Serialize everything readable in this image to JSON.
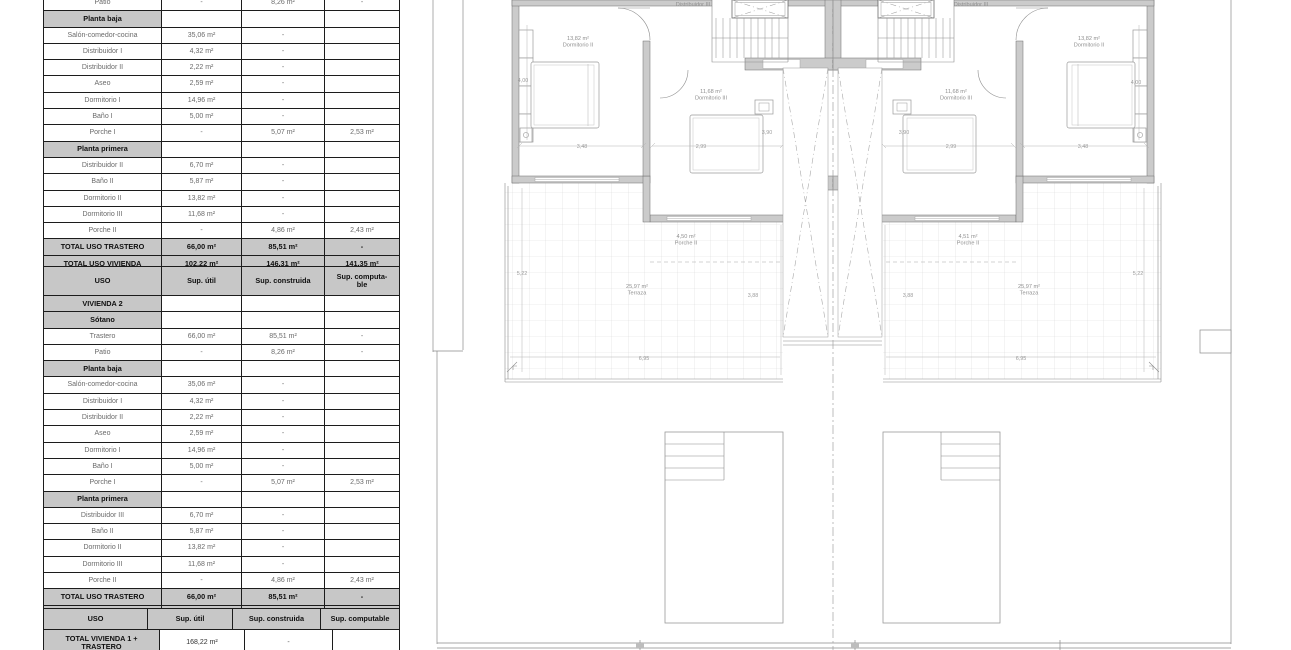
{
  "document": {
    "kind": "architectural plan sheet",
    "language": "es",
    "units": "m²"
  },
  "tables": {
    "columns": [
      "USO",
      "Sup. útil",
      "Sup. construida",
      "Sup. computable"
    ],
    "vivienda1": {
      "rows": [
        [
          "data",
          "Patio",
          "-",
          "8,26 m²",
          "-"
        ],
        [
          "section",
          "Planta baja",
          "",
          "",
          ""
        ],
        [
          "data",
          "Salón-comedor-cocina",
          "35,06 m²",
          "-",
          ""
        ],
        [
          "data",
          "Distribuidor I",
          "4,32 m²",
          "-",
          ""
        ],
        [
          "data",
          "Distribuidor II",
          "2,22 m²",
          "-",
          ""
        ],
        [
          "data",
          "Aseo",
          "2,59 m²",
          "-",
          ""
        ],
        [
          "data",
          "Dormitorio I",
          "14,96 m²",
          "-",
          ""
        ],
        [
          "data",
          "Baño I",
          "5,00 m²",
          "-",
          ""
        ],
        [
          "data",
          "Porche I",
          "-",
          "5,07 m²",
          "2,53 m²"
        ],
        [
          "section",
          "Planta primera",
          "",
          "",
          ""
        ],
        [
          "data",
          "Distribuidor II",
          "6,70 m²",
          "-",
          ""
        ],
        [
          "data",
          "Baño II",
          "5,87 m²",
          "-",
          ""
        ],
        [
          "data",
          "Dormitorio II",
          "13,82 m²",
          "-",
          ""
        ],
        [
          "data",
          "Dormitorio III",
          "11,68 m²",
          "-",
          ""
        ],
        [
          "data",
          "Porche II",
          "-",
          "4,86 m²",
          "2,43 m²"
        ],
        [
          "total",
          "TOTAL USO TRASTERO",
          "66,00 m²",
          "85,51 m²",
          "-"
        ],
        [
          "total",
          "TOTAL USO VIVIENDA",
          "102,22 m²",
          "146,31 m²",
          "141,35 m²"
        ]
      ]
    },
    "vivienda2": {
      "rows": [
        [
          "header",
          "USO",
          "Sup. útil",
          "Sup. construida",
          "Sup. computa-ble"
        ],
        [
          "section",
          "VIVIENDA 2",
          "",
          "",
          ""
        ],
        [
          "section",
          "Sótano",
          "",
          "",
          ""
        ],
        [
          "data",
          "Trastero",
          "66,00 m²",
          "85,51 m²",
          "-"
        ],
        [
          "data",
          "Patio",
          "-",
          "8,26 m²",
          "-"
        ],
        [
          "section",
          "Planta baja",
          "",
          "",
          ""
        ],
        [
          "data",
          "Salón-comedor-cocina",
          "35,06 m²",
          "-",
          ""
        ],
        [
          "data",
          "Distribuidor I",
          "4,32 m²",
          "-",
          ""
        ],
        [
          "data",
          "Distribuidor II",
          "2,22 m²",
          "-",
          ""
        ],
        [
          "data",
          "Aseo",
          "2,59 m²",
          "-",
          ""
        ],
        [
          "data",
          "Dormitorio I",
          "14,96 m²",
          "-",
          ""
        ],
        [
          "data",
          "Baño I",
          "5,00 m²",
          "-",
          ""
        ],
        [
          "data",
          "Porche I",
          "-",
          "5,07 m²",
          "2,53 m²"
        ],
        [
          "section",
          "Planta primera",
          "",
          "",
          ""
        ],
        [
          "data",
          "Distribuidor III",
          "6,70 m²",
          "-",
          ""
        ],
        [
          "data",
          "Baño II",
          "5,87 m²",
          "-",
          ""
        ],
        [
          "data",
          "Dormitorio II",
          "13,82 m²",
          "-",
          ""
        ],
        [
          "data",
          "Dormitorio III",
          "11,68 m²",
          "-",
          ""
        ],
        [
          "data",
          "Porche II",
          "-",
          "4,86 m²",
          "2,43 m²"
        ],
        [
          "total",
          "TOTAL USO TRASTERO",
          "66,00 m²",
          "85,51 m²",
          "-"
        ],
        [
          "total",
          "TOTAL USO VIVIENDA",
          "102,22 m²",
          "146,31 m²",
          "141,35 m²"
        ]
      ]
    },
    "totals": {
      "rows": [
        [
          "header",
          "USO",
          "Sup. útil",
          "Sup. construida",
          "Sup. computable"
        ],
        [
          "total2",
          "TOTAL VIVIENDA 1 + TRASTERO",
          "168,22 m²",
          "-",
          ""
        ]
      ]
    }
  },
  "plan": {
    "room_labels": [
      {
        "line1": "13,82 m²",
        "line2": "Dormitorio II",
        "x": 148,
        "y": 40
      },
      {
        "line1": "11,68 m²",
        "line2": "Dormitorio III",
        "x": 281,
        "y": 93
      },
      {
        "line2": "Distribuidor III",
        "x": 263,
        "y": 6
      },
      {
        "line1": "4,50 m²",
        "line2": "Porche II",
        "x": 256,
        "y": 238
      },
      {
        "line1": "25,97 m²",
        "line2": "Terraza",
        "x": 207,
        "y": 288
      },
      {
        "line1": "13,82 m²",
        "line2": "Dormitorio II",
        "x": 659,
        "y": 40
      },
      {
        "line1": "11,68 m²",
        "line2": "Dormitorio III",
        "x": 526,
        "y": 93
      },
      {
        "line2": "Distribuidor III",
        "x": 541,
        "y": 6
      },
      {
        "line1": "4,51 m²",
        "line2": "Porche II",
        "x": 538,
        "y": 238
      },
      {
        "line1": "25,97 m²",
        "line2": "Terraza",
        "x": 599,
        "y": 288
      }
    ],
    "dimensions": [
      {
        "text": "4,00",
        "x": 93,
        "y": 82
      },
      {
        "text": "3,48",
        "x": 152,
        "y": 148
      },
      {
        "text": "2,99",
        "x": 271,
        "y": 148
      },
      {
        "text": "3,90",
        "x": 337,
        "y": 134
      },
      {
        "text": "5,22",
        "x": 92,
        "y": 275
      },
      {
        "text": "3,88",
        "x": 323,
        "y": 297
      },
      {
        "text": "6,95",
        "x": 214,
        "y": 360
      },
      {
        "text": "2,99",
        "x": 521,
        "y": 148
      },
      {
        "text": "3,48",
        "x": 653,
        "y": 148
      },
      {
        "text": "4,00",
        "x": 706,
        "y": 84
      },
      {
        "text": "3,90",
        "x": 474,
        "y": 134
      },
      {
        "text": "5,22",
        "x": 708,
        "y": 275
      },
      {
        "text": "3,88",
        "x": 478,
        "y": 297
      },
      {
        "text": "6,95",
        "x": 591,
        "y": 360
      }
    ]
  },
  "colors": {
    "wall_gray": "#cbcbcb",
    "table_header_gray": "#c7c7c7",
    "line_dark": "#1c1c1c",
    "label_gray": "#8f8f8f"
  }
}
